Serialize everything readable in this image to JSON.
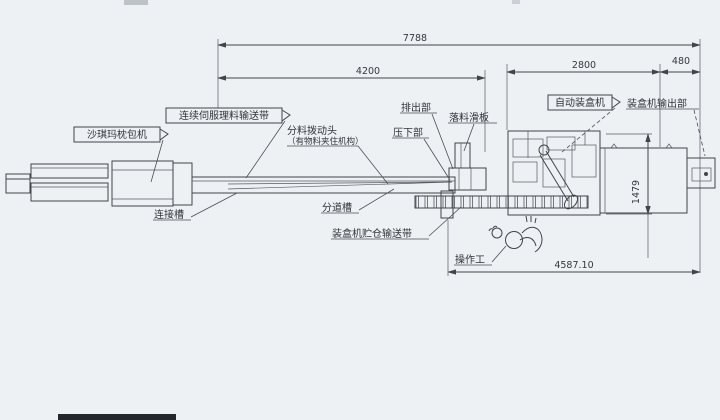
{
  "drawing": {
    "type": "engineering-layout-drawing",
    "colors": {
      "paper": "#eef1f4",
      "ink": "#40454c"
    },
    "dimensions": {
      "overall": "7788",
      "infeed": "4200",
      "cartoner": "2800",
      "outfeed": "480",
      "height": "1479",
      "working": "4587.10"
    },
    "labels": {
      "shaqima_machine": "沙琪玛枕包机",
      "servo_conveyor": "连续伺服理料输送带",
      "divider_head": "分料拨动头",
      "divider_head_note": "（有物料夹住机构）",
      "eject_section": "排出部",
      "drop_slide": "落料滑板",
      "press_down": "压下部",
      "auto_cartoner": "自动装盒机",
      "cartoner_output": "装盒机输出部",
      "connect_chute": "连接槽",
      "divide_chute": "分道槽",
      "storage_conveyor": "装盒机贮仓输送带",
      "operator": "操作工"
    }
  }
}
